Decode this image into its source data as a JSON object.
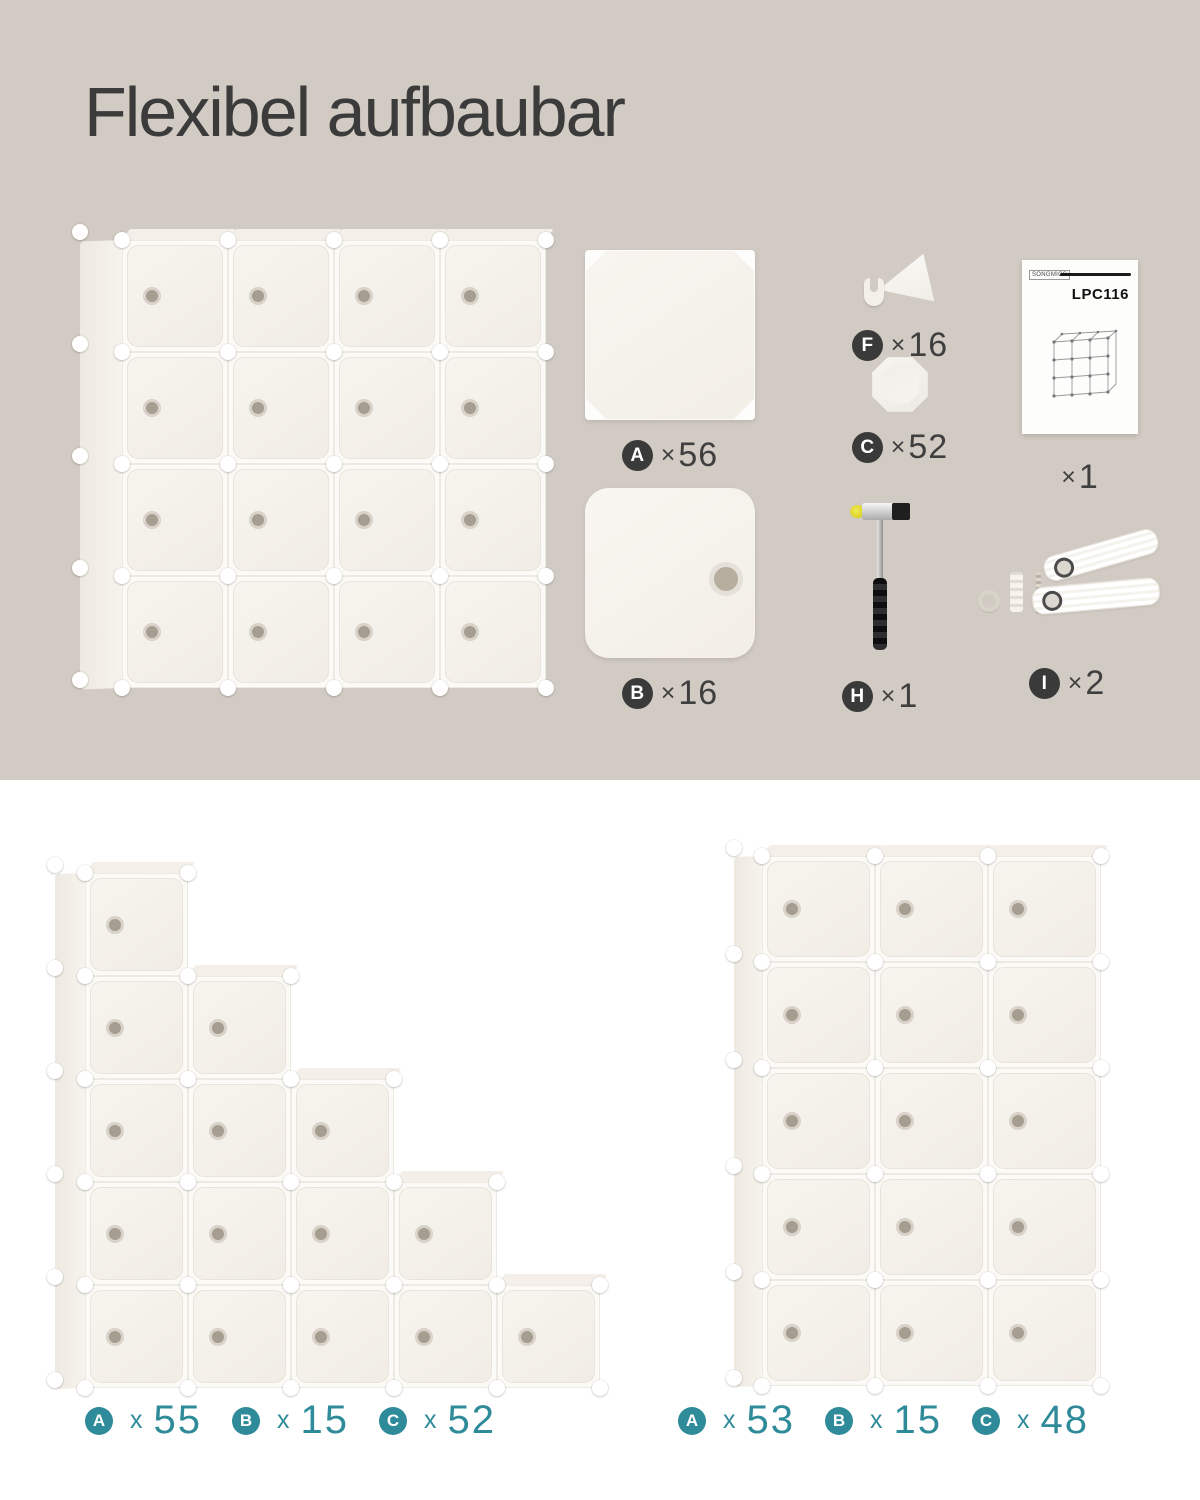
{
  "title": "Flexibel aufbaubar",
  "colors": {
    "background_top": "#d2cbc3",
    "background_bottom": "#ffffff",
    "accent_teal": "#2f8b99",
    "badge_dark": "#3a3a3a",
    "text_dark": "#3b3b3b",
    "cube_white": "#f4f1ea"
  },
  "parts": {
    "panel_a": {
      "letter": "A",
      "symbol": "×",
      "count": "56"
    },
    "panel_b": {
      "letter": "B",
      "symbol": "×",
      "count": "16"
    },
    "connector_f": {
      "letter": "F",
      "symbol": "×",
      "count": "16"
    },
    "connector_c": {
      "letter": "C",
      "symbol": "×",
      "count": "52"
    },
    "manual": {
      "symbol": "×",
      "count": "1",
      "model": "LPC116",
      "brand": "SONGMICS"
    },
    "hammer": {
      "letter": "H",
      "symbol": "×",
      "count": "1"
    },
    "straps": {
      "letter": "I",
      "symbol": "×",
      "count": "2"
    }
  },
  "configurations": {
    "staircase": {
      "legend": [
        {
          "letter": "A",
          "symbol": "x",
          "count": "55"
        },
        {
          "letter": "B",
          "symbol": "x",
          "count": "15"
        },
        {
          "letter": "C",
          "symbol": "x",
          "count": "52"
        }
      ]
    },
    "tower": {
      "legend": [
        {
          "letter": "A",
          "symbol": "x",
          "count": "53"
        },
        {
          "letter": "B",
          "symbol": "x",
          "count": "15"
        },
        {
          "letter": "C",
          "symbol": "x",
          "count": "48"
        }
      ]
    }
  },
  "units": {
    "main": {
      "columns": [
        4,
        4,
        4,
        4
      ],
      "cellW": 106,
      "cellH": 112,
      "side": 42,
      "top": true
    },
    "staircase": {
      "columns": [
        5,
        4,
        3,
        2,
        1
      ],
      "cellW": 103,
      "cellH": 103,
      "side": 30,
      "top": true
    },
    "tower": {
      "columns": [
        5,
        5,
        5
      ],
      "cellW": 113,
      "cellH": 106,
      "side": 28,
      "top": true
    }
  }
}
